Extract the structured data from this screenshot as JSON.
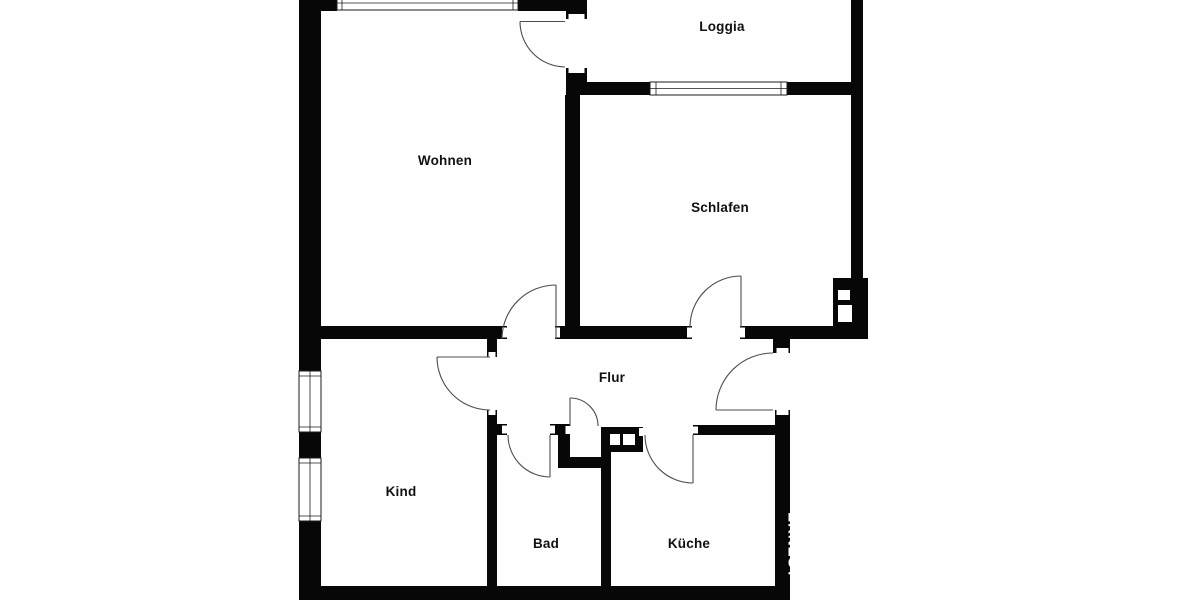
{
  "plan": {
    "type": "apartment-floor-plan",
    "background_color": "#fefefe",
    "wall_color": "#070707",
    "door_line_color": "#4d4d4d",
    "label_color": "#111111"
  },
  "rooms": [
    {
      "id": "wohnen",
      "label": "Wohnen"
    },
    {
      "id": "loggia",
      "label": "Loggia"
    },
    {
      "id": "schlafen",
      "label": "Schlafen"
    },
    {
      "id": "flur",
      "label": "Flur"
    },
    {
      "id": "kind",
      "label": "Kind"
    },
    {
      "id": "bad",
      "label": "Bad"
    },
    {
      "id": "kueche",
      "label": "Küche"
    }
  ],
  "watermark": {
    "text": "ERNEST",
    "color": "#ffffff"
  },
  "features": {
    "windows": 4,
    "doors": 8,
    "shafts": 2
  }
}
